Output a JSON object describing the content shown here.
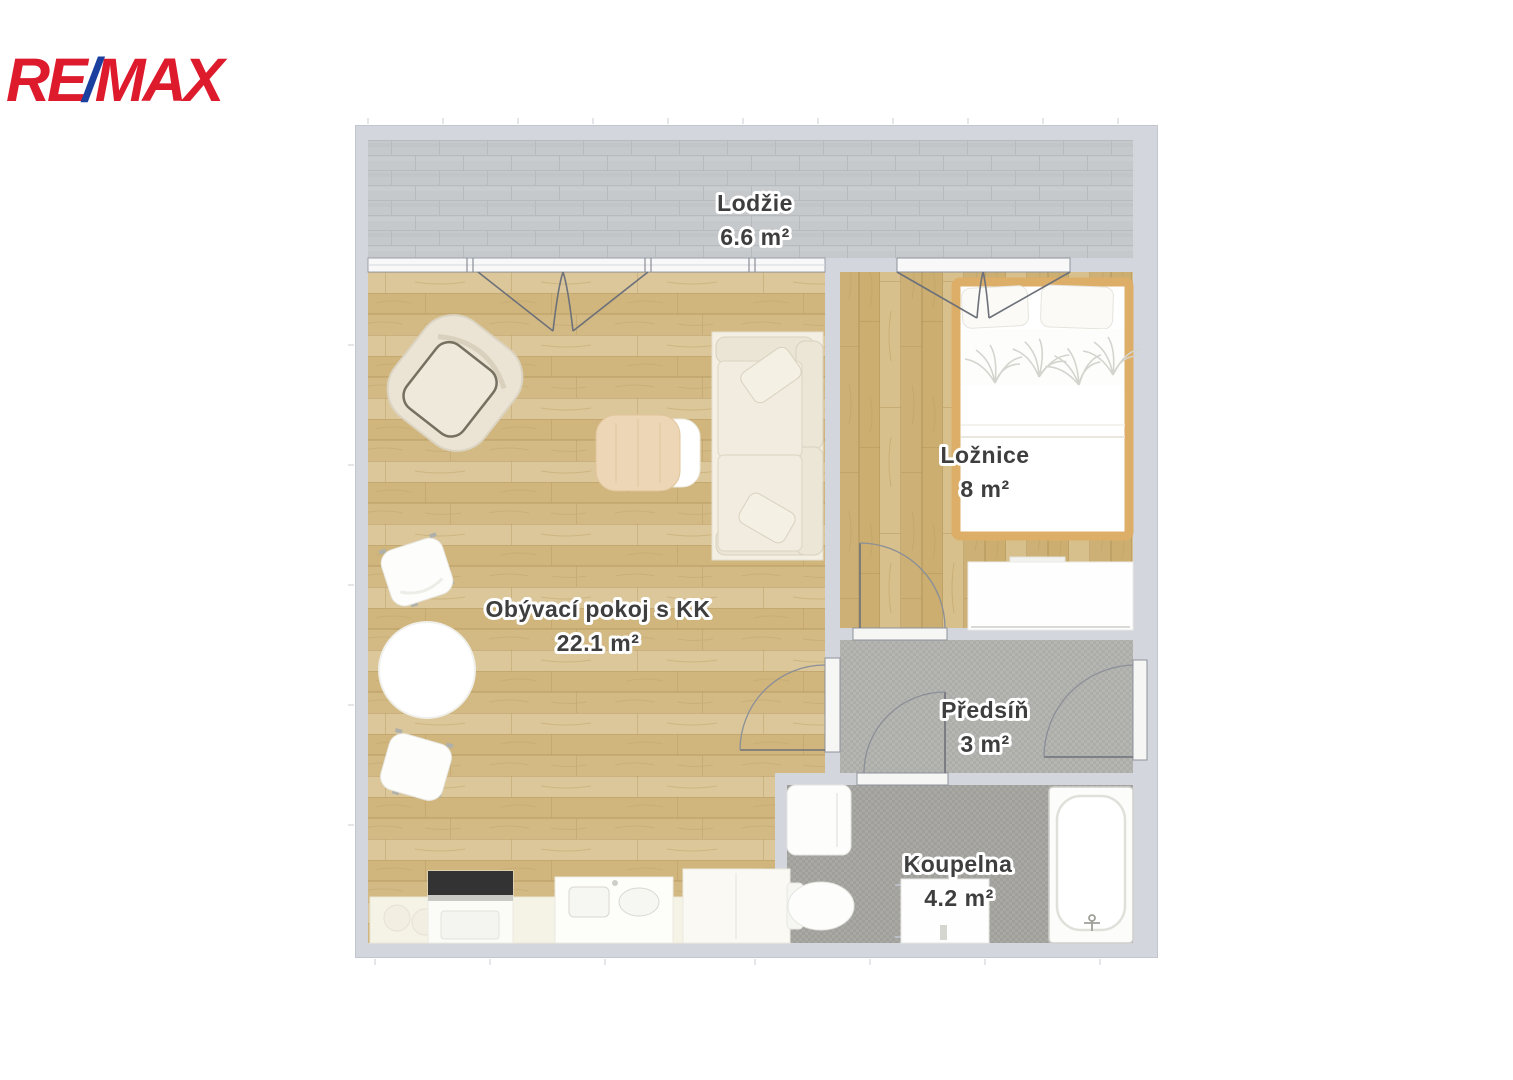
{
  "logo": {
    "re": "RE",
    "slash": "/",
    "max": "MAX"
  },
  "rooms": {
    "loggia": {
      "name": "Lodžie",
      "area": "6.6 m²"
    },
    "living": {
      "name": "Obývací pokoj s KK",
      "area": "22.1 m²"
    },
    "bedroom": {
      "name": "Ložnice",
      "area": "8 m²"
    },
    "hall": {
      "name": "Předsíň",
      "area": "3 m²"
    },
    "bathroom": {
      "name": "Koupelna",
      "area": "4.2 m²"
    }
  },
  "colors": {
    "remax_red": "#dd1b2d",
    "remax_blue": "#1b3f9f",
    "wall": "#d3d6dd",
    "wood_floor": "#d7c08d",
    "loggia_brick": "#c6c9cb",
    "hall_tile": "#b4b4b0",
    "bath_tile": "#a8a8a3",
    "label_text": "#3e3e3e",
    "bed_frame": "#dcae68"
  }
}
